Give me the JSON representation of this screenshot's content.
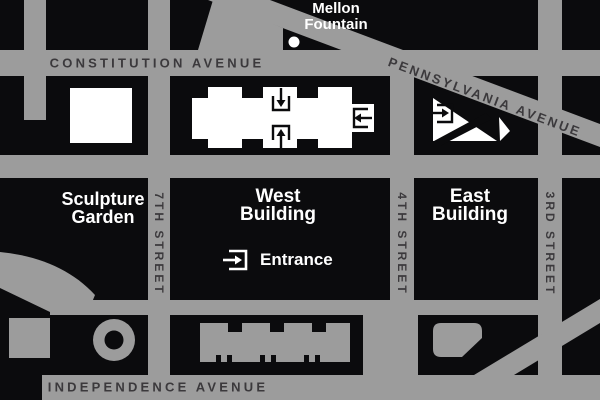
{
  "title": "National Gallery of Art area map",
  "colors": {
    "street_gray": "#9c9c9c",
    "block_black": "#0b0b0d",
    "building_white": "#ffffff",
    "street_label": "#3b393c",
    "poi_label": "#ffffff"
  },
  "streets": {
    "constitution": "CONSTITUTION AVENUE",
    "pennsylvania": "PENNSYLVANIA AVENUE",
    "independence": "INDEPENDENCE AVENUE",
    "seventh": "7TH STREET",
    "fourth": "4TH STREET",
    "third": "3RD STREET"
  },
  "pois": {
    "mellon_fountain": {
      "line1": "Mellon",
      "line2": "Fountain"
    },
    "sculpture_garden": {
      "line1": "Sculpture",
      "line2": "Garden"
    },
    "west_building": {
      "line1": "West",
      "line2": "Building"
    },
    "east_building": {
      "line1": "East",
      "line2": "Building"
    },
    "entrance": {
      "label": "Entrance"
    }
  },
  "icons": {
    "entrance_marker": "arrow-into-bracket",
    "west_top_entrance": "arrow-down-into-bracket",
    "west_bottom_entrance": "arrow-up-into-bracket",
    "west_right_entrance": "arrow-left-into-bracket",
    "east_entrance": "arrow-right-into-bracket",
    "fountain_dot": "white-dot"
  }
}
